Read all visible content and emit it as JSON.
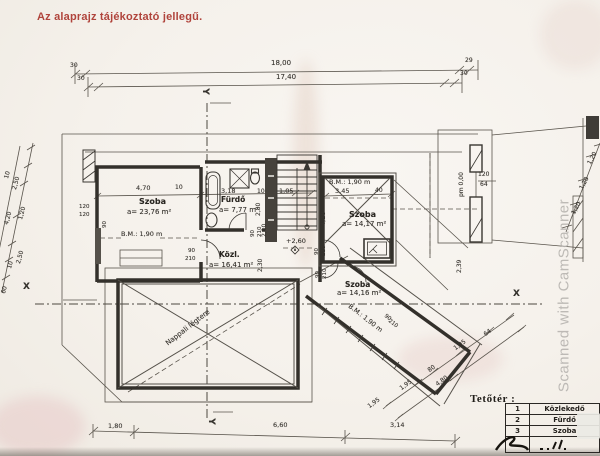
{
  "note": "Az alaprajz tájékoztató jellegű.",
  "watermark": "Scanned with CamScanner",
  "sections": {
    "x": "X",
    "y": "Y"
  },
  "rooms": {
    "szoba1": {
      "name": "Szoba",
      "area": "a= 23,76 m²",
      "bm": "B.M.: 1,90 m"
    },
    "furdo": {
      "name": "Fürdő",
      "area": "a= 7,77 m²"
    },
    "kozl": {
      "name": "Közl.",
      "area": "a= 16,41 m²"
    },
    "szoba2": {
      "name": "Szoba",
      "area": "a= 14,17 m²",
      "bm": "B.M.: 1,90 m"
    },
    "szoba3": {
      "name": "Szoba",
      "area": "a= 14,16 m²",
      "bm": "B.M.: 1,90 m"
    },
    "void": {
      "name": "Nappali légtere"
    }
  },
  "levels": {
    "upper": "+2,60"
  },
  "dims": {
    "top": {
      "total": "18,00",
      "inner": "17,40",
      "l30a": "30",
      "l30b": "30",
      "r29": "29",
      "r30": "30"
    },
    "interior_top": [
      "4,70",
      "10",
      "3,18",
      "10",
      "1,05"
    ],
    "left_chain": [
      "10",
      "2,50",
      "1,20",
      "4,20",
      "2,50",
      "10",
      "60"
    ],
    "bottom": [
      "1,80",
      "6,60",
      "3,14"
    ],
    "right_chain": [
      "1,20",
      "1,20",
      "1,20"
    ],
    "wing_chain": [
      "1,95",
      "80",
      "4,80",
      "1,95",
      "64",
      "1,95"
    ],
    "szoba2": {
      "w": "3,45",
      "h": "4,10",
      "e": "40",
      "r": "2,39"
    },
    "bay": {
      "pm": "pm 0,00",
      "w": "120",
      "h": "64"
    },
    "left_wall": {
      "a": "120",
      "b": "120",
      "c": "90"
    },
    "stair": {
      "a": "2,80",
      "b": "2,10",
      "c": "2,30"
    }
  },
  "doors": [
    {
      "w": "90",
      "h": "210"
    },
    {
      "w": "90",
      "h": "210"
    },
    {
      "w": "90",
      "h": "210"
    },
    {
      "w": "90",
      "h": "210"
    },
    {
      "w": "90",
      "h": "210"
    }
  ],
  "legend": {
    "title": "Tetőtér :",
    "rows": [
      {
        "num": "1",
        "label": "Közlekedő"
      },
      {
        "num": "2",
        "label": "Fürdő"
      },
      {
        "num": "3",
        "label": "Szoba"
      },
      {
        "num": "",
        "label": ""
      }
    ]
  }
}
